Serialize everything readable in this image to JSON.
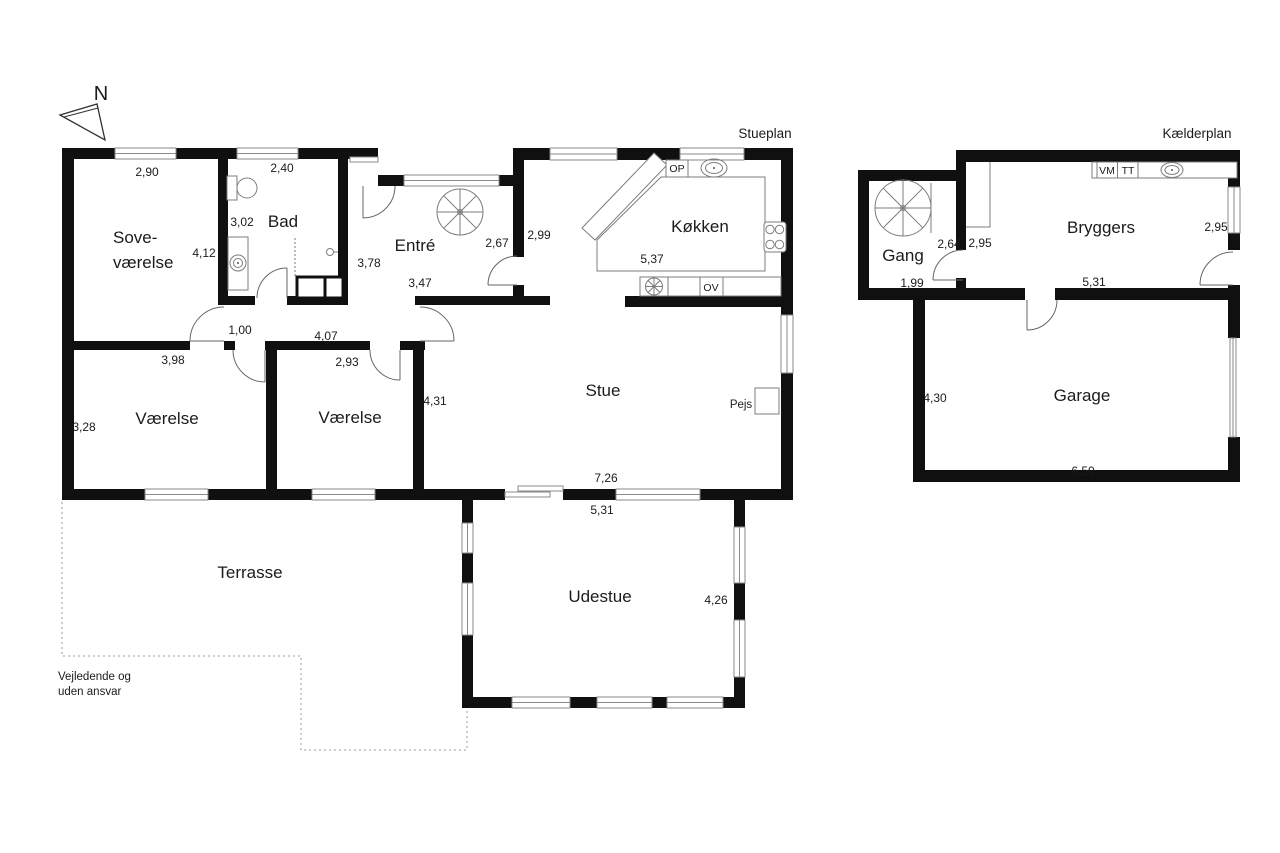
{
  "titles": {
    "stueplan": "Stueplan",
    "kaelderplan": "Kælderplan"
  },
  "north_label": "N",
  "disclaimer": {
    "line1": "Vejledende og",
    "line2": "uden ansvar"
  },
  "rooms": {
    "sovevaerelse_line1": "Sove-",
    "sovevaerelse_line2": "værelse",
    "bad": "Bad",
    "entre": "Entré",
    "koekken": "Køkken",
    "stue": "Stue",
    "vaerelse1": "Værelse",
    "vaerelse2": "Værelse",
    "terrasse": "Terrasse",
    "udestue": "Udestue",
    "gang": "Gang",
    "bryggers": "Bryggers",
    "garage": "Garage"
  },
  "fixtures": {
    "pejs": "Pejs",
    "op": "OP",
    "ov": "OV",
    "vm": "VM",
    "tt": "TT"
  },
  "measurements": {
    "sove_width": "2,90",
    "sove_height": "4,12",
    "bad_width": "2,40",
    "bad_height": "3,02",
    "entre_height": "3,78",
    "entre_width": "3,47",
    "entre_right": "2,67",
    "koekken_left": "2,99",
    "koekken_width": "5,37",
    "hall_width": "1,00",
    "hall_length": "4,07",
    "vaerelse1_width": "3,98",
    "vaerelse1_height": "3,28",
    "vaerelse2_width": "2,93",
    "stue_left": "4,31",
    "stue_width": "7,26",
    "udestue_width": "5,31",
    "udestue_height": "4,26",
    "gang_top": "2,64",
    "gang_width": "1,99",
    "bryggers_left": "2,95",
    "bryggers_right": "2,95",
    "bryggers_width": "5,31",
    "garage_height": "4,30",
    "garage_width": "6,50"
  },
  "colors": {
    "wall": "#101010",
    "fixture_line": "#7d7d7d",
    "text": "#1b1b1b",
    "background": "#ffffff"
  }
}
